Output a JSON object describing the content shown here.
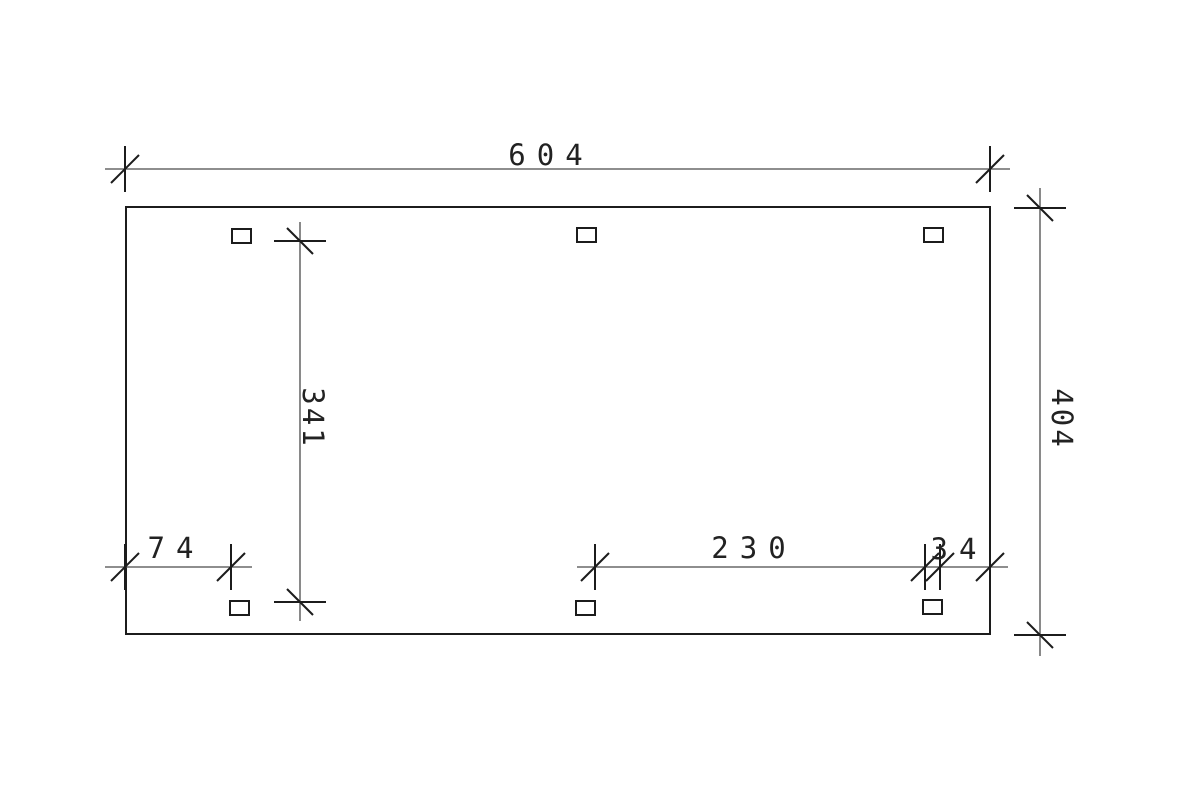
{
  "drawing": {
    "type": "technical-plan",
    "background_color": "#ffffff",
    "line_color": "#1c1c1c",
    "dim_line_color": "#4a4a4a",
    "text_color": "#222222",
    "dims": {
      "top_width": "604",
      "right_height": "404",
      "inner_height": "341",
      "bottom_left": "74",
      "bottom_middle": "230",
      "bottom_right": "34"
    },
    "post_count": 6
  }
}
